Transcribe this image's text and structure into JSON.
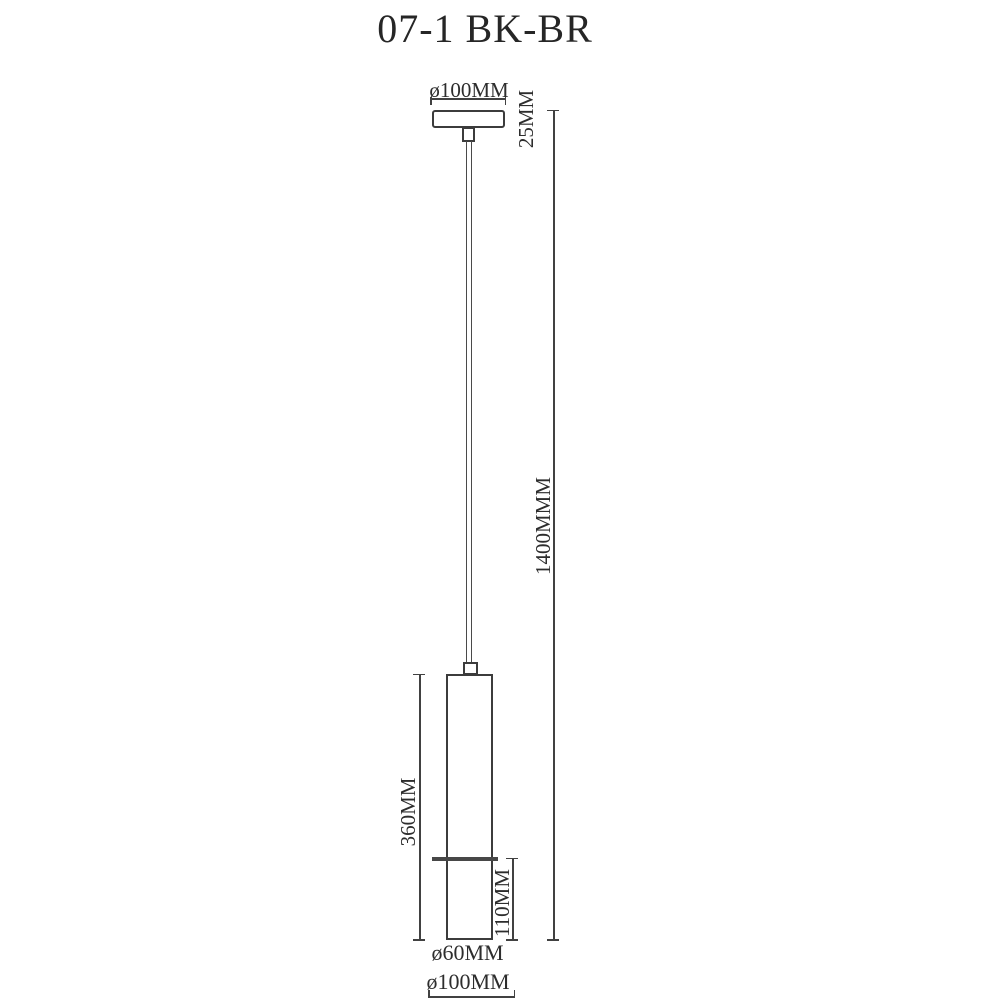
{
  "title": "07-1 BK-BR",
  "labels": {
    "canopy_diameter": "ø100MM",
    "canopy_height": "25MM",
    "overall_drop": "1400MMM",
    "body_height": "360MM",
    "lower_section_height": "110MM",
    "body_diameter": "ø60MM",
    "base_diameter": "ø100MM"
  },
  "colors": {
    "background": "#ffffff",
    "line": "#414141",
    "separator": "#474747",
    "text": "#2d2d2d"
  }
}
